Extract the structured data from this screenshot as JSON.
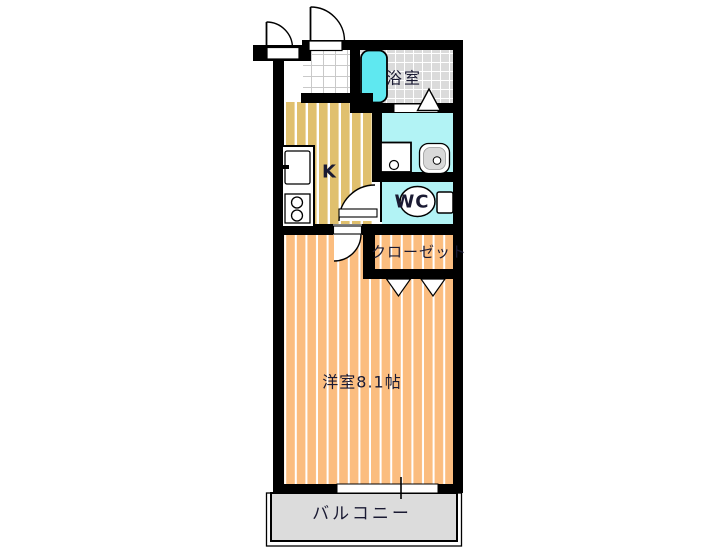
{
  "floorplan": {
    "rooms": {
      "bathroom": {
        "label": "浴室"
      },
      "kitchen": {
        "label": "K"
      },
      "toilet": {
        "label": "WC"
      },
      "closet": {
        "label": "クローゼット"
      },
      "western_room": {
        "label": "洋室8.1帖",
        "size_tatami": "8.1"
      },
      "balcony": {
        "label": "バルコニー"
      }
    },
    "fixtures": [
      "bathtub",
      "toilet-bowl",
      "washing-machine-pan",
      "vanity-basin",
      "kitchen-counter",
      "kitchen-sink",
      "two-burner-stove",
      "entrance-door-swing",
      "interior-door-swing",
      "bath-folding-door",
      "closet-folding-door",
      "sliding-window"
    ],
    "colors": {
      "wall": "#000000",
      "kitchen_floor": "#E0C06E",
      "room_floor": "#FBBD7F",
      "wet_area": "#B2F3F5",
      "bathtub": "#5FE8F0",
      "bath_tile": "#DBDBDB",
      "tile_line": "#C9C9C9",
      "closet_floor": "#FAD3DB",
      "balcony_floor": "#DCDCDC",
      "fixture_fill": "#FFFFFF",
      "text": "#1A1A33"
    }
  }
}
